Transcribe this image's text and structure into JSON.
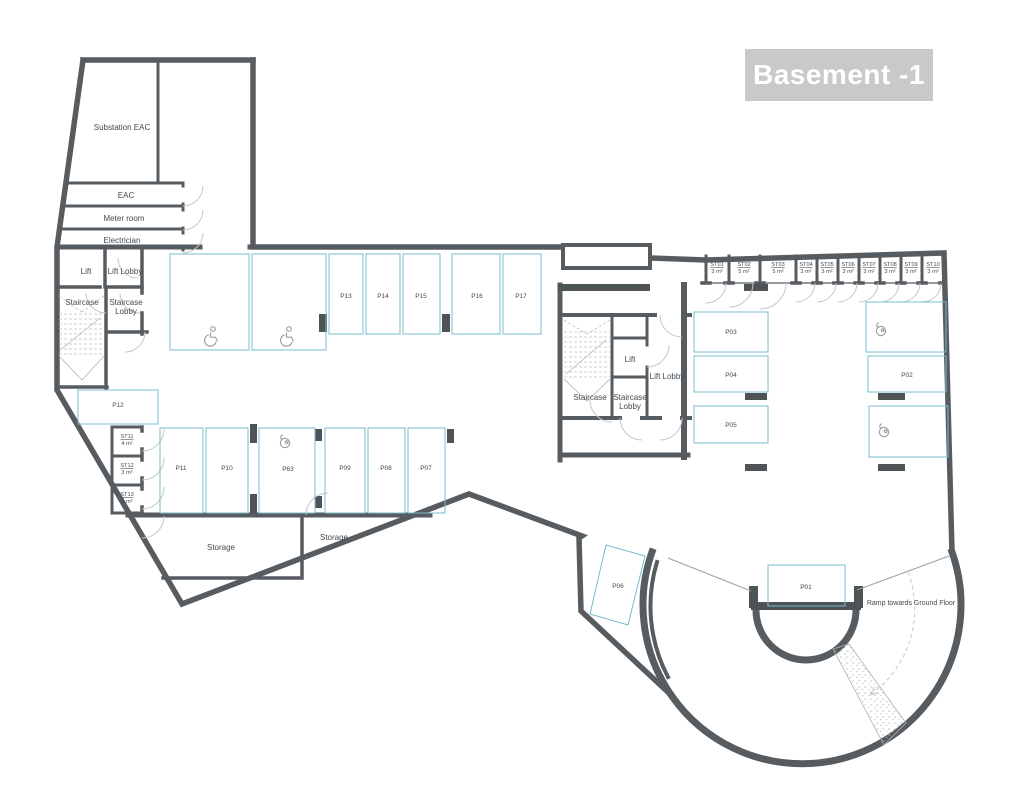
{
  "title": "Basement -1",
  "colors": {
    "wall": "#575c60",
    "parking_line": "#79bccd",
    "door_arc": "#c5c8ca",
    "column": "#4e5356",
    "title_background": "#c9c9c9",
    "title_text": "#ffffff",
    "label_text": "#45494c"
  },
  "rooms": {
    "substation": "Substation EAC",
    "eac": "EAC",
    "meter_room": "Meter room",
    "electrician": "Electrician",
    "storage_west": "Storage",
    "storage_east": "Storage",
    "ramp": "Ramp towards Ground Floor",
    "west_core": {
      "lift": "Lift",
      "lift_lobby": "Lift Lobby",
      "staircase": "Staircase",
      "staircase_lobby_line1": "Staircase",
      "staircase_lobby_line2": "Lobby"
    },
    "east_core": {
      "lift": "Lift",
      "lift_lobby": "Lift Lobby",
      "staircase": "Staircase",
      "staircase_lobby_line1": "Staircase",
      "staircase_lobby_line2": "Lobby"
    }
  },
  "parking": {
    "p01": "P01",
    "p02": "P02",
    "p03": "P03",
    "p04": "P04",
    "p05": "P05",
    "p06": "P06",
    "p07": "P07",
    "p08": "P08",
    "p09": "P09",
    "p10": "P10",
    "p11": "P11",
    "p12": "P12",
    "p13": "P13",
    "p14": "P14",
    "p15": "P15",
    "p16": "P16",
    "p17": "P17",
    "p63": "P63"
  },
  "storage_units": {
    "st01": {
      "id": "ST01",
      "area": "3 m²"
    },
    "st02": {
      "id": "ST02",
      "area": "5 m²"
    },
    "st03": {
      "id": "ST03",
      "area": "5 m²"
    },
    "st04": {
      "id": "ST04",
      "area": "3 m²"
    },
    "st05": {
      "id": "ST05",
      "area": "3 m²"
    },
    "st06": {
      "id": "ST06",
      "area": "3 m²"
    },
    "st07": {
      "id": "ST07",
      "area": "3 m²"
    },
    "st08": {
      "id": "ST08",
      "area": "3 m²"
    },
    "st09": {
      "id": "ST09",
      "area": "3 m²"
    },
    "st10": {
      "id": "ST10",
      "area": "3 m²"
    },
    "st11": {
      "id": "ST11",
      "area": "4 m²"
    },
    "st12": {
      "id": "ST12",
      "area": "3 m²"
    },
    "st13": {
      "id": "ST13",
      "area": "4 m²"
    }
  }
}
